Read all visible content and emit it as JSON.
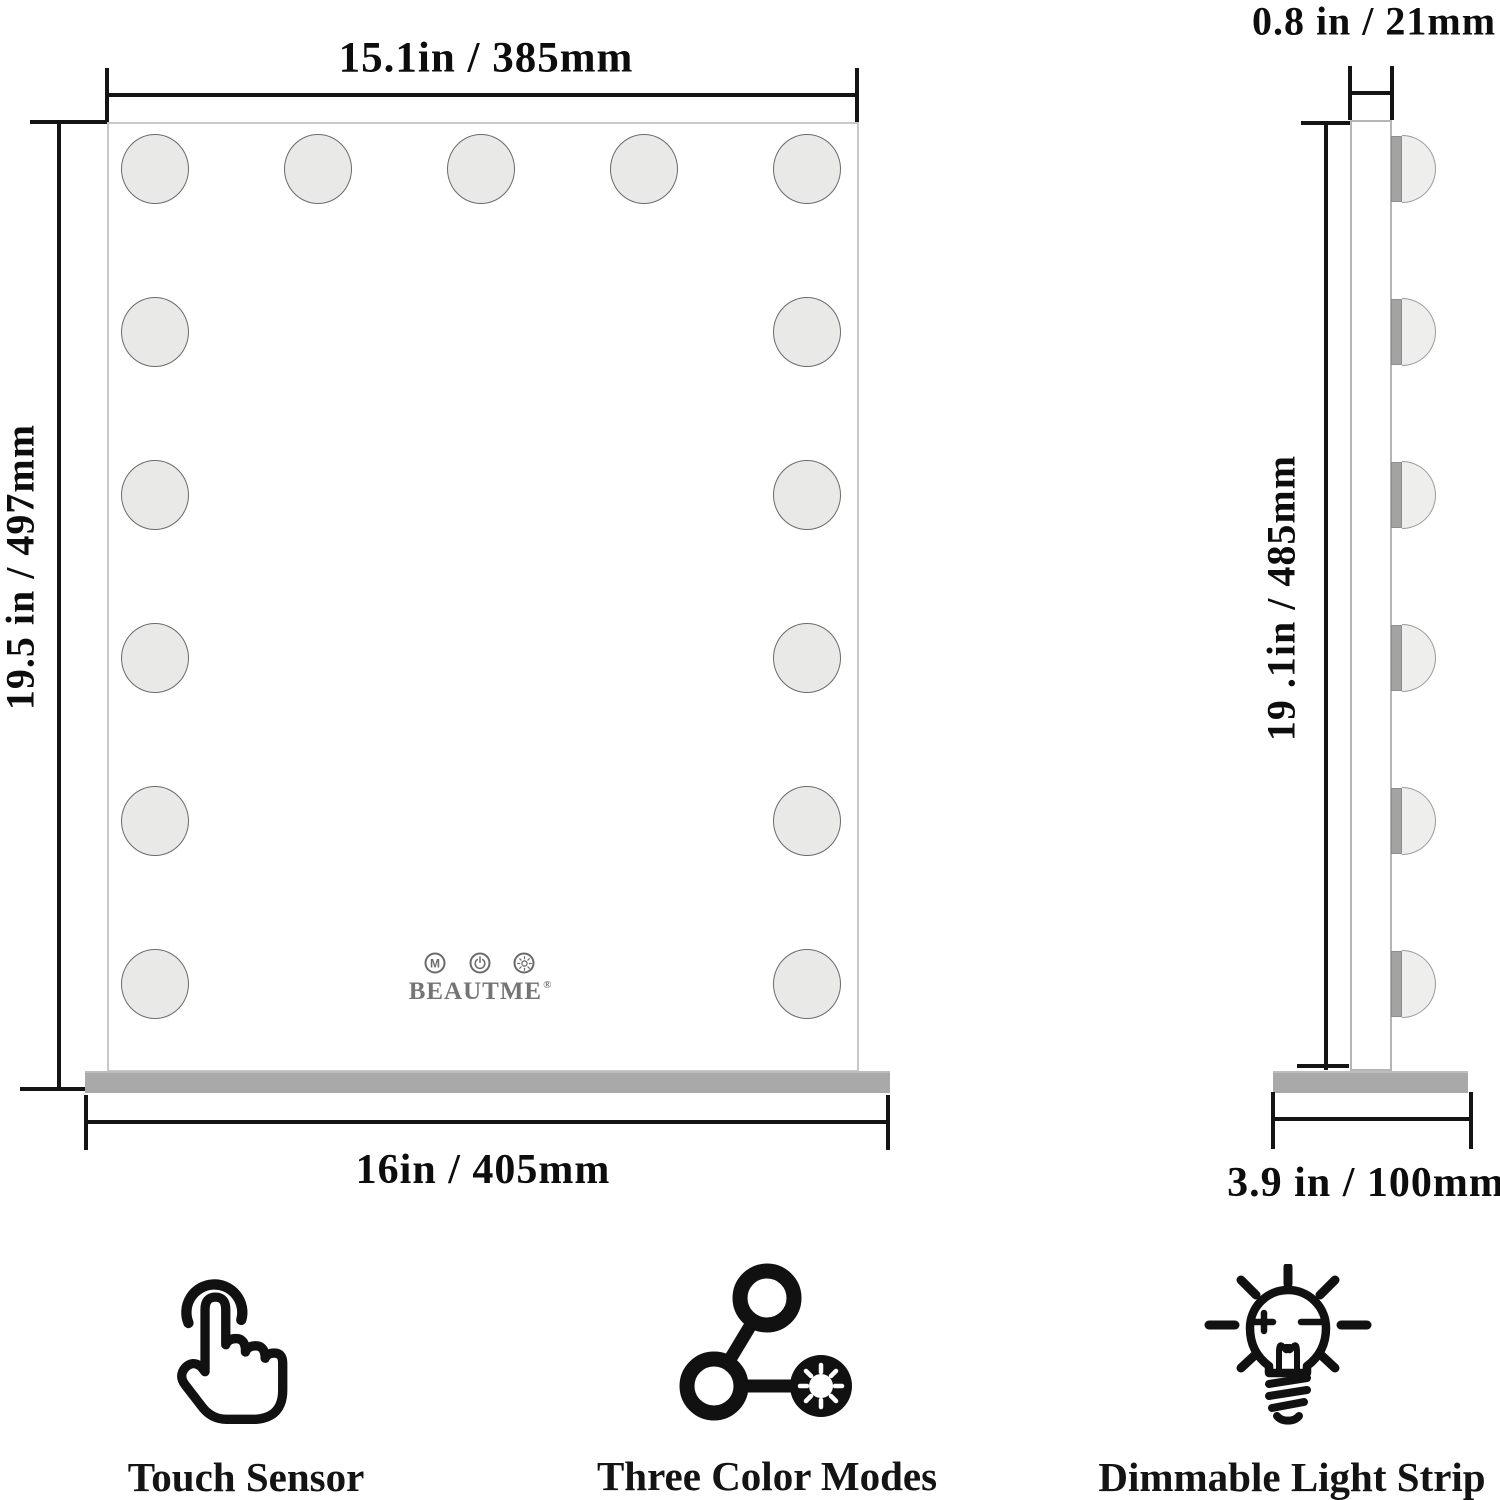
{
  "front_view": {
    "width_dimension": "15.1in / 385mm",
    "height_dimension": "19.5 in / 497mm",
    "base_width_dimension": "16in / 405mm",
    "bulb_count": 15,
    "brand": "BEAUTME",
    "registered_mark": "®",
    "touch_buttons": [
      {
        "label": "M"
      },
      {
        "icon": "power"
      },
      {
        "icon": "brightness"
      }
    ]
  },
  "side_view": {
    "depth_dimension": "0.8 in / 21mm",
    "height_dimension": "19 .1in / 485mm",
    "base_depth_dimension": "3.9 in / 100mm",
    "bulb_count": 6
  },
  "features": [
    {
      "id": "touch-sensor",
      "label": "Touch Sensor"
    },
    {
      "id": "three-color-modes",
      "label": "Three Color Modes"
    },
    {
      "id": "dimmable-light-strip",
      "label": "Dimmable Light Strip"
    }
  ],
  "colors": {
    "line_black": "#141414",
    "mirror_border": "#c9c9c9",
    "bulb_fill": "#e9e9e7",
    "bulb_stroke": "#6b6b6b",
    "base_gray": "#a9a9a9",
    "button_gray": "#6a6a6a",
    "logo_gray": "#757575"
  }
}
